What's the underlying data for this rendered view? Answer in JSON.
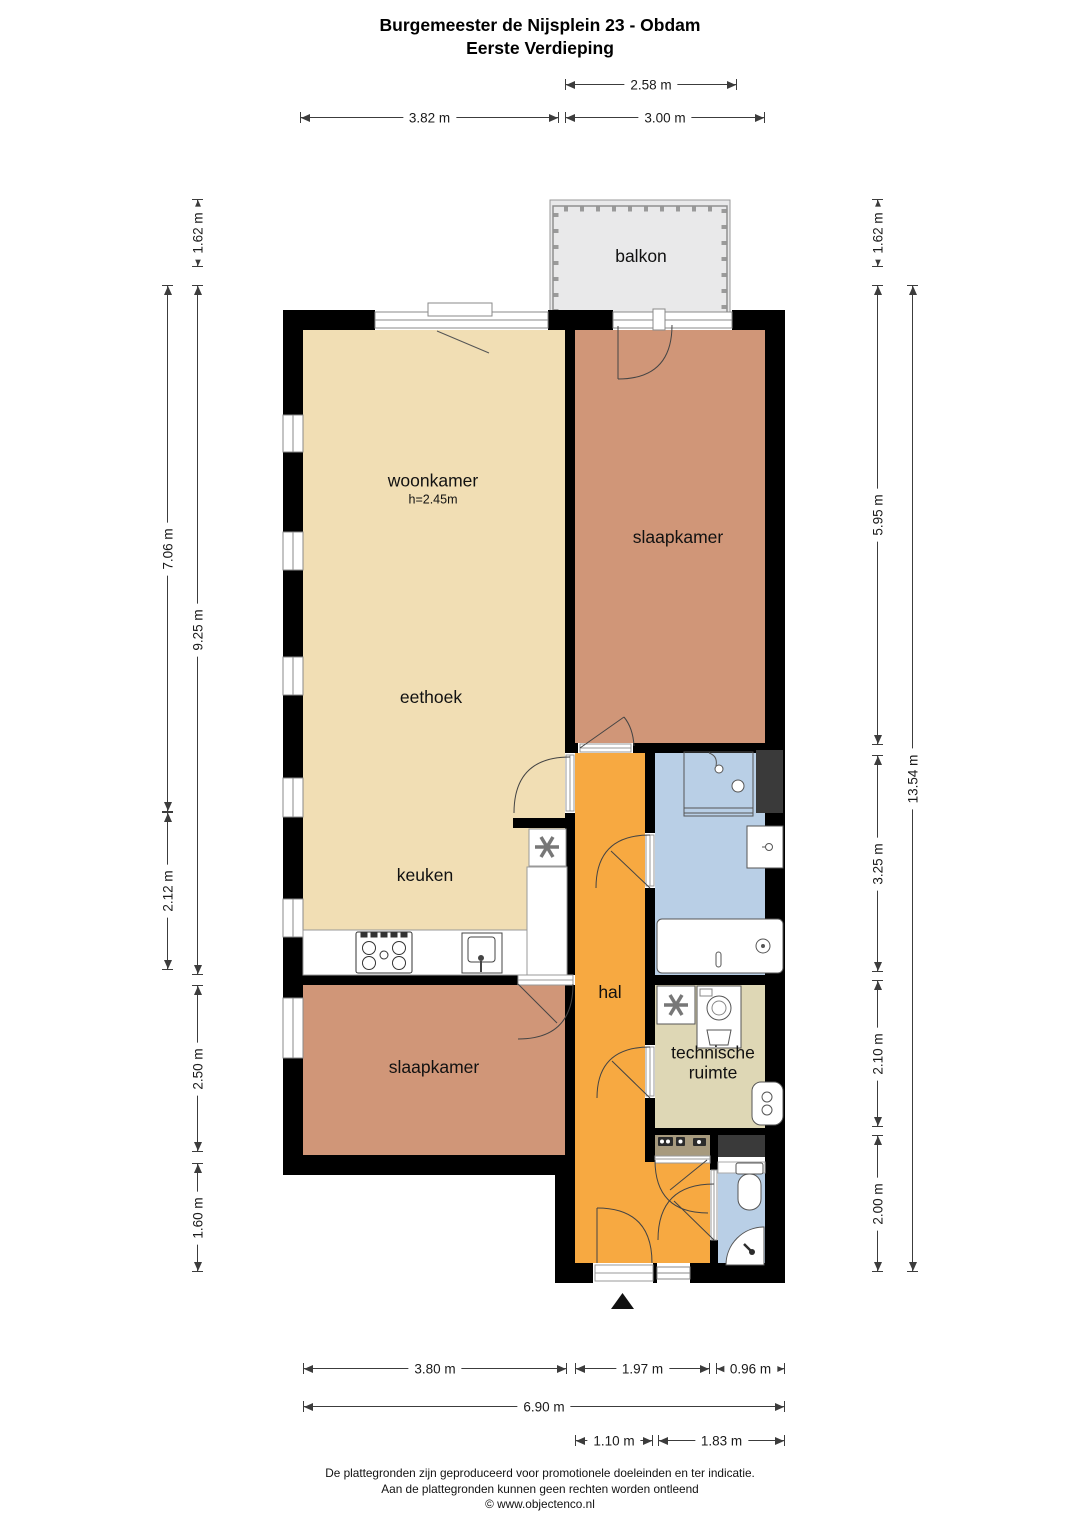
{
  "title": {
    "line1": "Burgemeester de Nijsplein 23 - Obdam",
    "line2": "Eerste Verdieping"
  },
  "rooms": [
    {
      "id": "balkon",
      "label": "balkon",
      "cx": 641,
      "cy": 257
    },
    {
      "id": "woonkamer",
      "label": "woonkamer",
      "sublabel": "h=2.45m",
      "cx": 433,
      "cy": 489
    },
    {
      "id": "slaapkamer-1",
      "label": "slaapkamer",
      "cx": 678,
      "cy": 538
    },
    {
      "id": "eethoek",
      "label": "eethoek",
      "cx": 431,
      "cy": 698
    },
    {
      "id": "keuken",
      "label": "keuken",
      "cx": 425,
      "cy": 876
    },
    {
      "id": "hal",
      "label": "hal",
      "cx": 610,
      "cy": 993
    },
    {
      "id": "slaapkamer-2",
      "label": "slaapkamer",
      "cx": 434,
      "cy": 1068
    },
    {
      "id": "technische-ruimte",
      "label": "technische ruimte",
      "cx": 713,
      "cy": 1063,
      "wrap": true,
      "width": 120
    }
  ],
  "dimensions": {
    "top": [
      {
        "label": "2.58 m",
        "x1": 565,
        "x2": 737,
        "y": 84
      },
      {
        "label": "3.82 m",
        "x1": 300,
        "x2": 559,
        "y": 117
      },
      {
        "label": "3.00 m",
        "x1": 565,
        "x2": 765,
        "y": 117
      }
    ],
    "left": [
      {
        "label": "1.62 m",
        "x": 197,
        "y1": 199,
        "y2": 267
      },
      {
        "label": "7.06 m",
        "x": 167,
        "y1": 285,
        "y2": 812
      },
      {
        "label": "9.25 m",
        "x": 197,
        "y1": 285,
        "y2": 975
      },
      {
        "label": "2.12 m",
        "x": 167,
        "y1": 812,
        "y2": 970
      },
      {
        "label": "2.50 m",
        "x": 197,
        "y1": 985,
        "y2": 1152
      },
      {
        "label": "1.60 m",
        "x": 197,
        "y1": 1163,
        "y2": 1272
      }
    ],
    "right": [
      {
        "label": "1.62 m",
        "x": 877,
        "y1": 199,
        "y2": 267
      },
      {
        "label": "5.95 m",
        "x": 877,
        "y1": 285,
        "y2": 745
      },
      {
        "label": "13.54 m",
        "x": 912,
        "y1": 285,
        "y2": 1272
      },
      {
        "label": "3.25 m",
        "x": 877,
        "y1": 755,
        "y2": 972
      },
      {
        "label": "2.10 m",
        "x": 877,
        "y1": 980,
        "y2": 1127
      },
      {
        "label": "2.00 m",
        "x": 877,
        "y1": 1135,
        "y2": 1272
      }
    ],
    "bottom": [
      {
        "label": "3.80 m",
        "x1": 303,
        "x2": 567,
        "y": 1368
      },
      {
        "label": "1.97 m",
        "x1": 575,
        "x2": 710,
        "y": 1368
      },
      {
        "label": "0.96 m",
        "x1": 716,
        "x2": 785,
        "y": 1368
      },
      {
        "label": "6.90 m",
        "x1": 303,
        "x2": 785,
        "y": 1406
      },
      {
        "label": "1.10 m",
        "x1": 575,
        "x2": 653,
        "y": 1440
      },
      {
        "label": "1.83 m",
        "x1": 658,
        "x2": 785,
        "y": 1440
      }
    ]
  },
  "footer": {
    "line1": "De plattegronden zijn geproduceerd voor promotionele doeleinden en ter indicatie.",
    "line2": "Aan de plattegronden kunnen geen rechten worden ontleend",
    "line3": "© www.objectenco.nl"
  },
  "colors": {
    "living": "#f1deb4",
    "bedroom": "#d09678",
    "hall": "#f7a941",
    "bath": "#b9cfe6",
    "tech": "#ded7b5",
    "meter": "#a79a7e",
    "balcony": "#e9e9ea",
    "wall": "#000000",
    "shaft": "#3a3a3a"
  },
  "fixtures": [
    "shower",
    "washbasin",
    "bathtub",
    "toilet",
    "fountain",
    "washing-machine",
    "ventilation",
    "boiler",
    "stove",
    "sink",
    "kitchen-counter",
    "meter-cupboard",
    "balcony-railing",
    "entrance-arrow"
  ]
}
